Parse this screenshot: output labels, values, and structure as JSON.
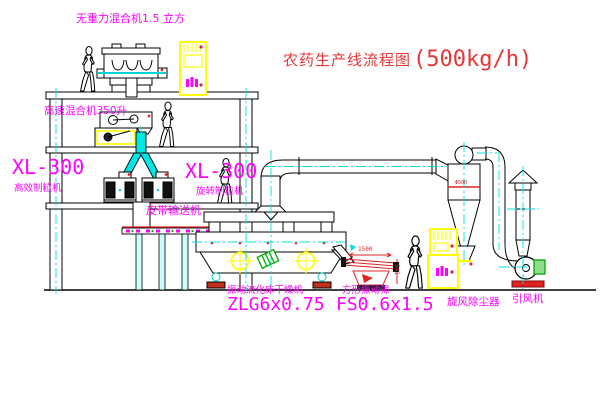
{
  "title": {
    "name": "农药生产线流程图",
    "capacity": "(500kg/h)"
  },
  "equipment_labels": {
    "gravityless_mixer": "无重力混合机1.5 立方",
    "high_speed_mixer": "高速混合机350升",
    "granulator_left": {
      "model": "XL-300",
      "name": "高效制粒机"
    },
    "granulator_right": {
      "model": "XL-300",
      "name": "旋转制粒机"
    },
    "belt_conveyor": "皮带输送机",
    "dryer": {
      "name": "振动流化床干燥机",
      "model": "ZLG6x0.75"
    },
    "screen": {
      "name": "方形振动筛",
      "model": "FS0.6x1.5"
    },
    "cyclone": "旋风除尘器",
    "fan": "引风机"
  },
  "dimensions": {
    "screen_length": "1500",
    "screen_height": "541",
    "cyclone_note": "Φ500"
  },
  "colors": {
    "label_magenta": "#ff00ff",
    "title_red": "#e43838",
    "centerline_cyan": "#00e0e0",
    "cabinet_yellow": "#ffff00",
    "dimension_red": "#e02525",
    "motor_green": "#00aa00"
  }
}
